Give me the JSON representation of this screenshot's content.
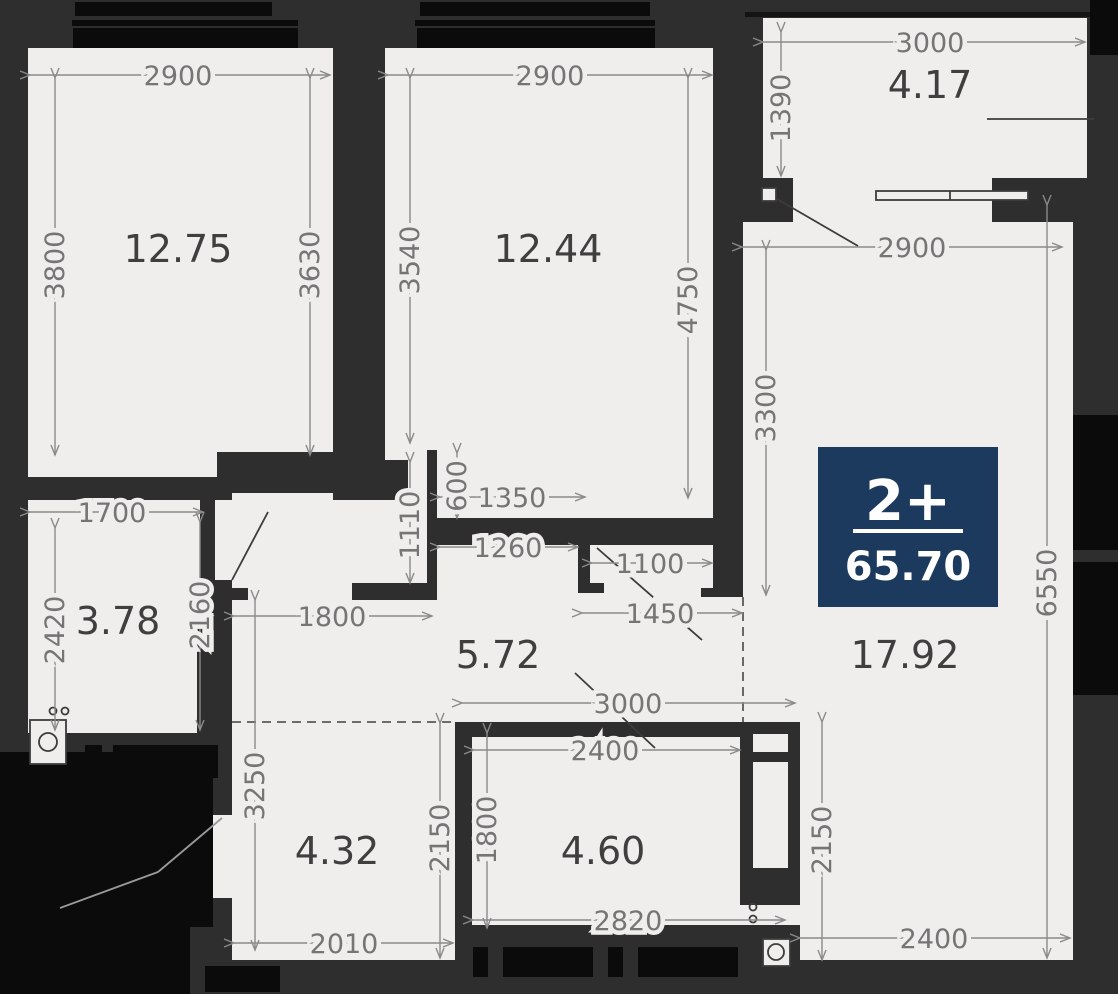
{
  "badge": {
    "rooms": "2+",
    "area": "65.70",
    "color": "#1c3a5e"
  },
  "rooms": [
    {
      "name": "bedroom-1",
      "area": "12.75"
    },
    {
      "name": "bedroom-2",
      "area": "12.44"
    },
    {
      "name": "balcony",
      "area": "4.17"
    },
    {
      "name": "living-room",
      "area": "17.92"
    },
    {
      "name": "bathroom",
      "area": "3.78"
    },
    {
      "name": "hallway",
      "area": "5.72"
    },
    {
      "name": "corridor",
      "area": "4.32"
    },
    {
      "name": "kitchen-niche",
      "area": "4.60"
    }
  ],
  "dims_h": [
    {
      "value": "2900"
    },
    {
      "value": "2900"
    },
    {
      "value": "3000"
    },
    {
      "value": "2900"
    },
    {
      "value": "1700"
    },
    {
      "value": "1350"
    },
    {
      "value": "1260"
    },
    {
      "value": "1100"
    },
    {
      "value": "1450"
    },
    {
      "value": "1800"
    },
    {
      "value": "3000"
    },
    {
      "value": "2400"
    },
    {
      "value": "2820"
    },
    {
      "value": "2010"
    },
    {
      "value": "2400"
    }
  ],
  "dims_v": [
    {
      "value": "3800"
    },
    {
      "value": "3630"
    },
    {
      "value": "3540"
    },
    {
      "value": "4750"
    },
    {
      "value": "1390"
    },
    {
      "value": "3300"
    },
    {
      "value": "6550"
    },
    {
      "value": "2420"
    },
    {
      "value": "2160"
    },
    {
      "value": "1110"
    },
    {
      "value": "600"
    },
    {
      "value": "3250"
    },
    {
      "value": "2150"
    },
    {
      "value": "1800"
    },
    {
      "value": "2150"
    }
  ],
  "colors": {
    "wall": "#2e2e2e",
    "floor": "#efeeec",
    "window_black": "#0b0b0b",
    "dim_line": "#8a8a8a",
    "badge_navy": "#1c3a5e"
  },
  "icons": [
    "washing-machine-icon",
    "toilet-icon",
    "door-swing",
    "balcony-door"
  ]
}
